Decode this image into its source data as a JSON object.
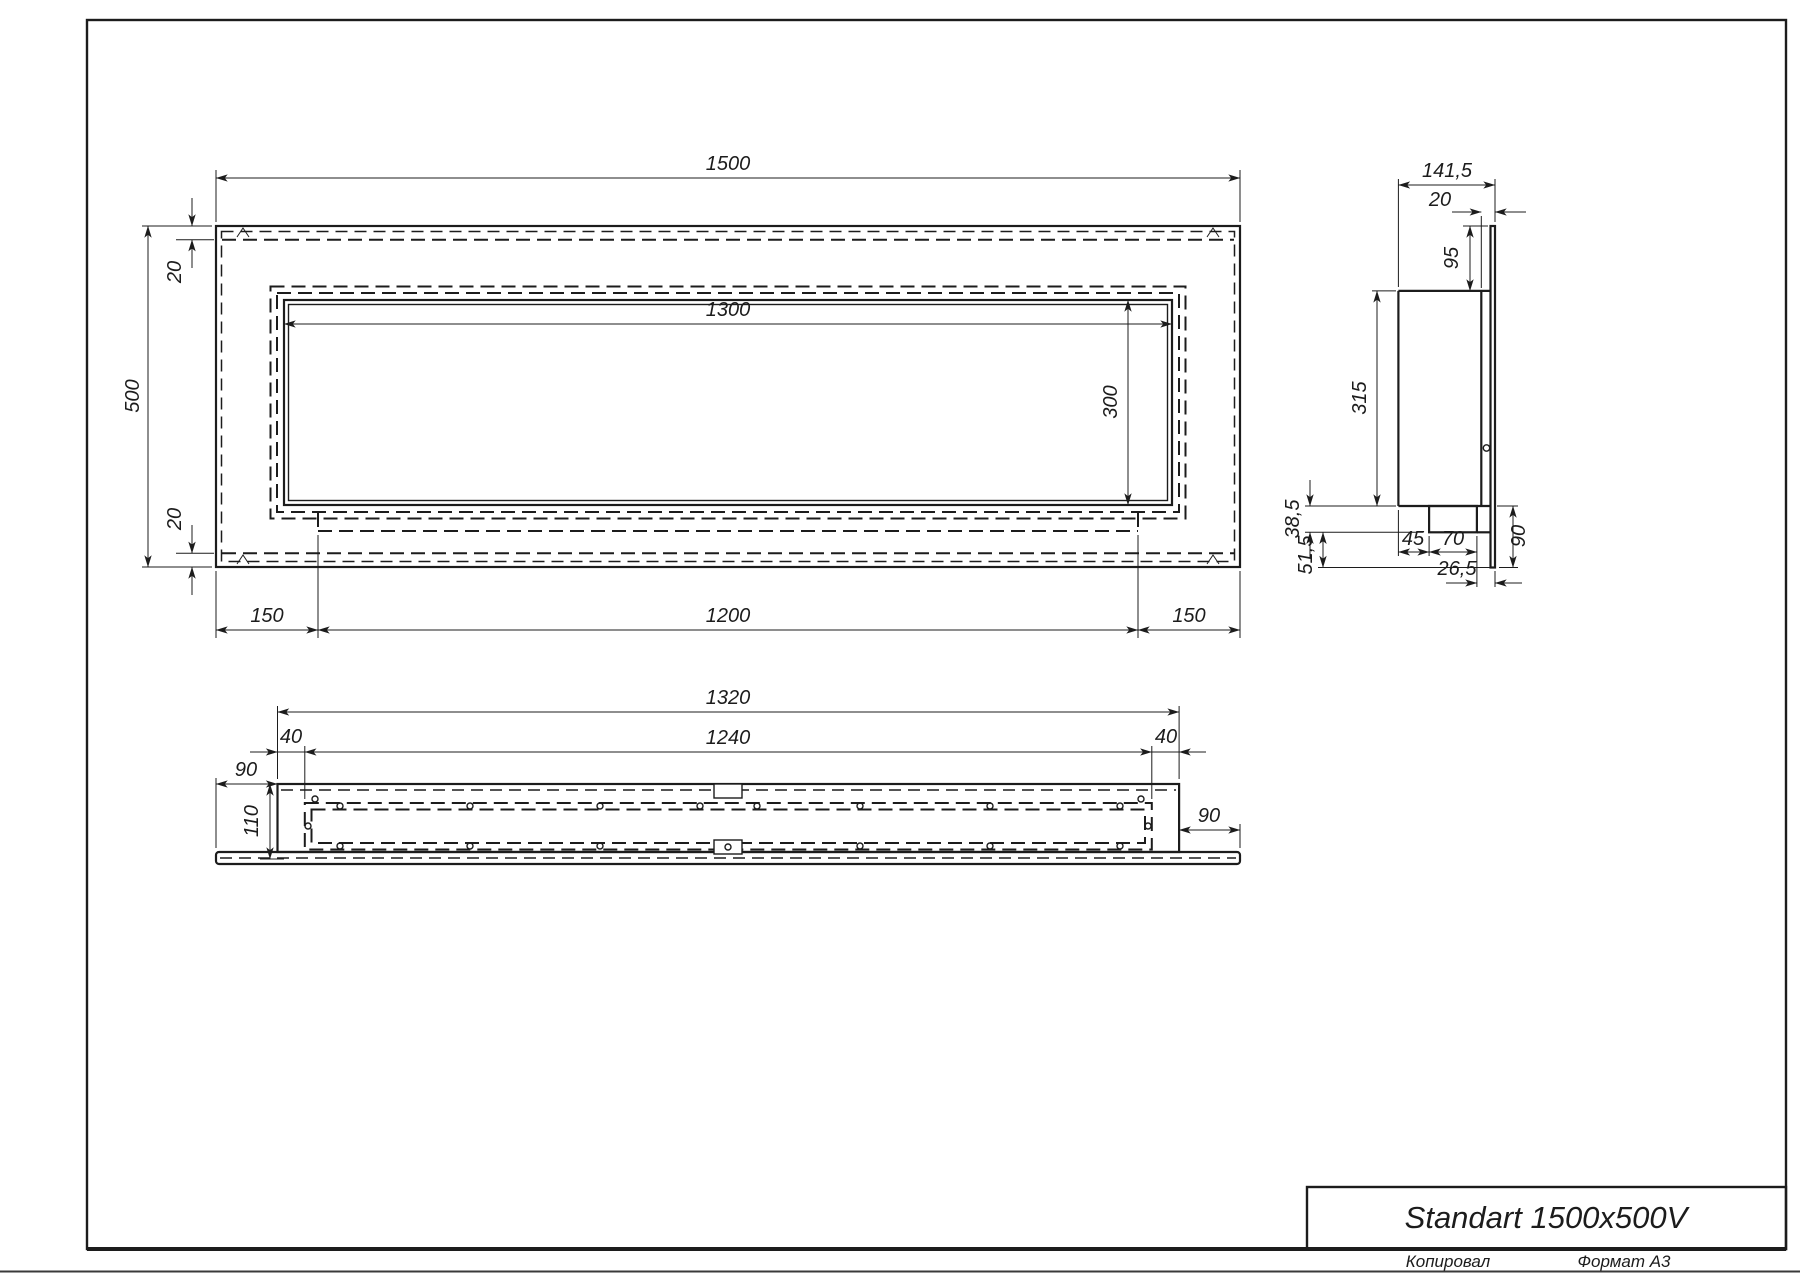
{
  "page": {
    "background": "#ffffff",
    "line_color": "#1c1c1c"
  },
  "title_block": {
    "title": "Standart 1500x500V",
    "copied_label": "Копировал",
    "format_label": "Формат А3"
  },
  "front_view": {
    "dims": {
      "total_width": "1500",
      "total_height": "500",
      "top_inset": "20",
      "bottom_inset": "20",
      "opening_width": "1300",
      "opening_height": "300",
      "margin_left": "150",
      "tray_length": "1200",
      "margin_right": "150"
    }
  },
  "side_view": {
    "dims": {
      "total_depth": "141,5",
      "glass_offset": "20",
      "top_offset": "95",
      "body_height": "315",
      "bracket_height": "38,5",
      "bracket_inset": "45",
      "bracket_width": "70",
      "front_gap": "26,5",
      "lower_drop": "51,5",
      "lower_height": "90"
    }
  },
  "bottom_view": {
    "dims": {
      "body_length": "1320",
      "inner_length": "1240",
      "inset_left": "40",
      "inset_right": "40",
      "flange_left": "90",
      "flange_right": "90",
      "depth": "110"
    }
  }
}
